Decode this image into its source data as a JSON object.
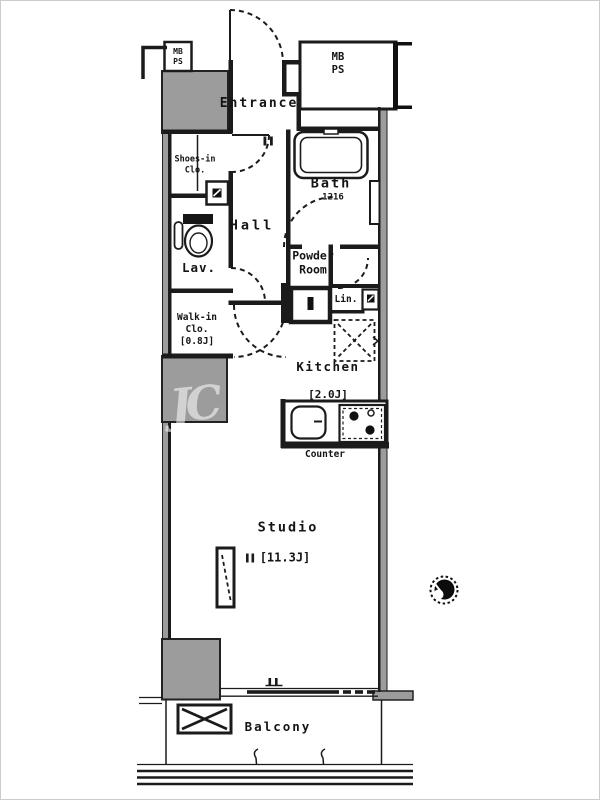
{
  "colors": {
    "wall_black": "#1b1b1b",
    "shaft_gray": "#9c9c9c",
    "text": "#141414",
    "page_border": "#cccccc"
  },
  "labels": {
    "meter_box_top_left": {
      "line1": "MB",
      "line2": "PS"
    },
    "meter_box_top_right": {
      "line1": "MB",
      "line2": "PS"
    },
    "entrance": "Entrance",
    "shoes_closet": {
      "line1": "Shoes-in",
      "line2": "Clo."
    },
    "bath": {
      "name": "Bath",
      "size": "1216"
    },
    "hall": "Hall",
    "lavatory": "Lav.",
    "powder_room": {
      "line1": "Powder",
      "line2": "Room"
    },
    "linen": "Lin.",
    "walk_in_closet": {
      "line1": "Walk-in",
      "line2": "Clo.",
      "line3": "[0.8J]"
    },
    "kitchen": {
      "name": "Kitchen",
      "size": "[2.0J]"
    },
    "counter": "Counter",
    "studio": {
      "name": "Studio",
      "size": "[11.3J]"
    },
    "balcony": "Balcony",
    "watermark": "JC"
  }
}
